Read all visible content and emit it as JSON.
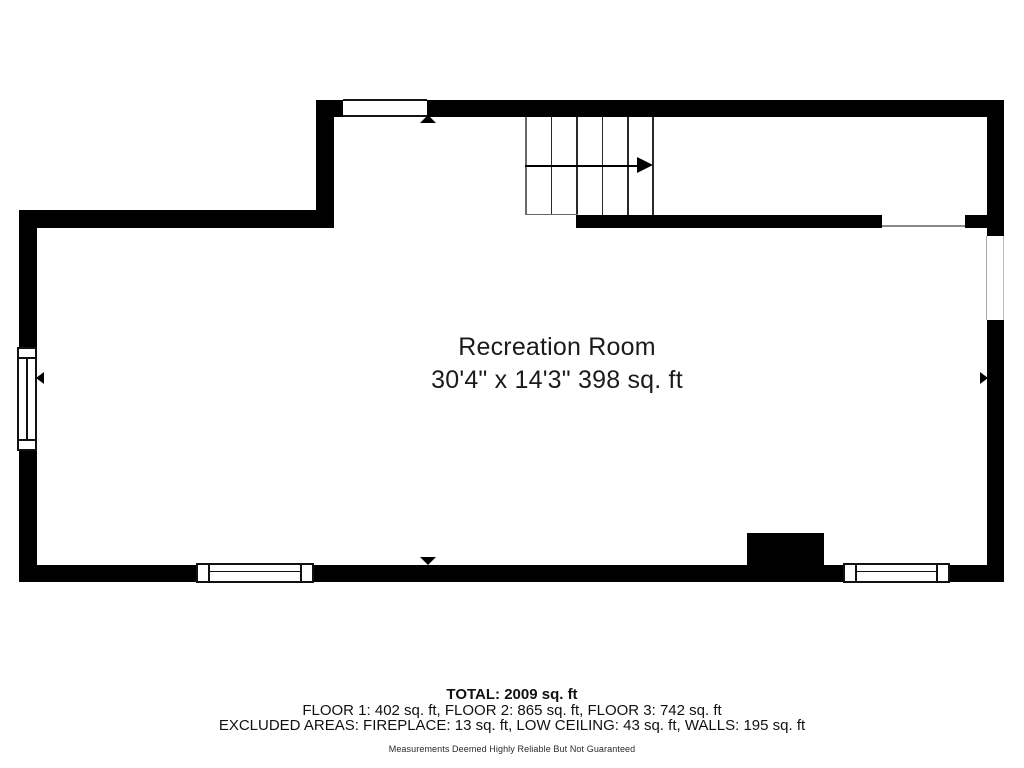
{
  "floor_plan": {
    "room": {
      "name": "Recreation Room",
      "dimensions": "30'4\" x 14'3\" 398 sq. ft"
    },
    "stairs": {
      "direction_icon": "right-arrow",
      "tread_count": 5
    },
    "markers": [
      "up-triangle",
      "down-triangle",
      "left-triangle",
      "right-triangle"
    ],
    "colors": {
      "wall": "#000000",
      "background": "#ffffff",
      "text": "#1b1b1b"
    }
  },
  "summary": {
    "total": "TOTAL: 2009 sq. ft",
    "floors": "FLOOR 1: 402 sq. ft, FLOOR 2: 865 sq. ft, FLOOR 3: 742 sq. ft",
    "excluded": "EXCLUDED AREAS: FIREPLACE: 13 sq. ft, LOW CEILING: 43 sq. ft, WALLS: 195 sq. ft",
    "disclaimer": "Measurements Deemed Highly Reliable But Not Guaranteed"
  }
}
